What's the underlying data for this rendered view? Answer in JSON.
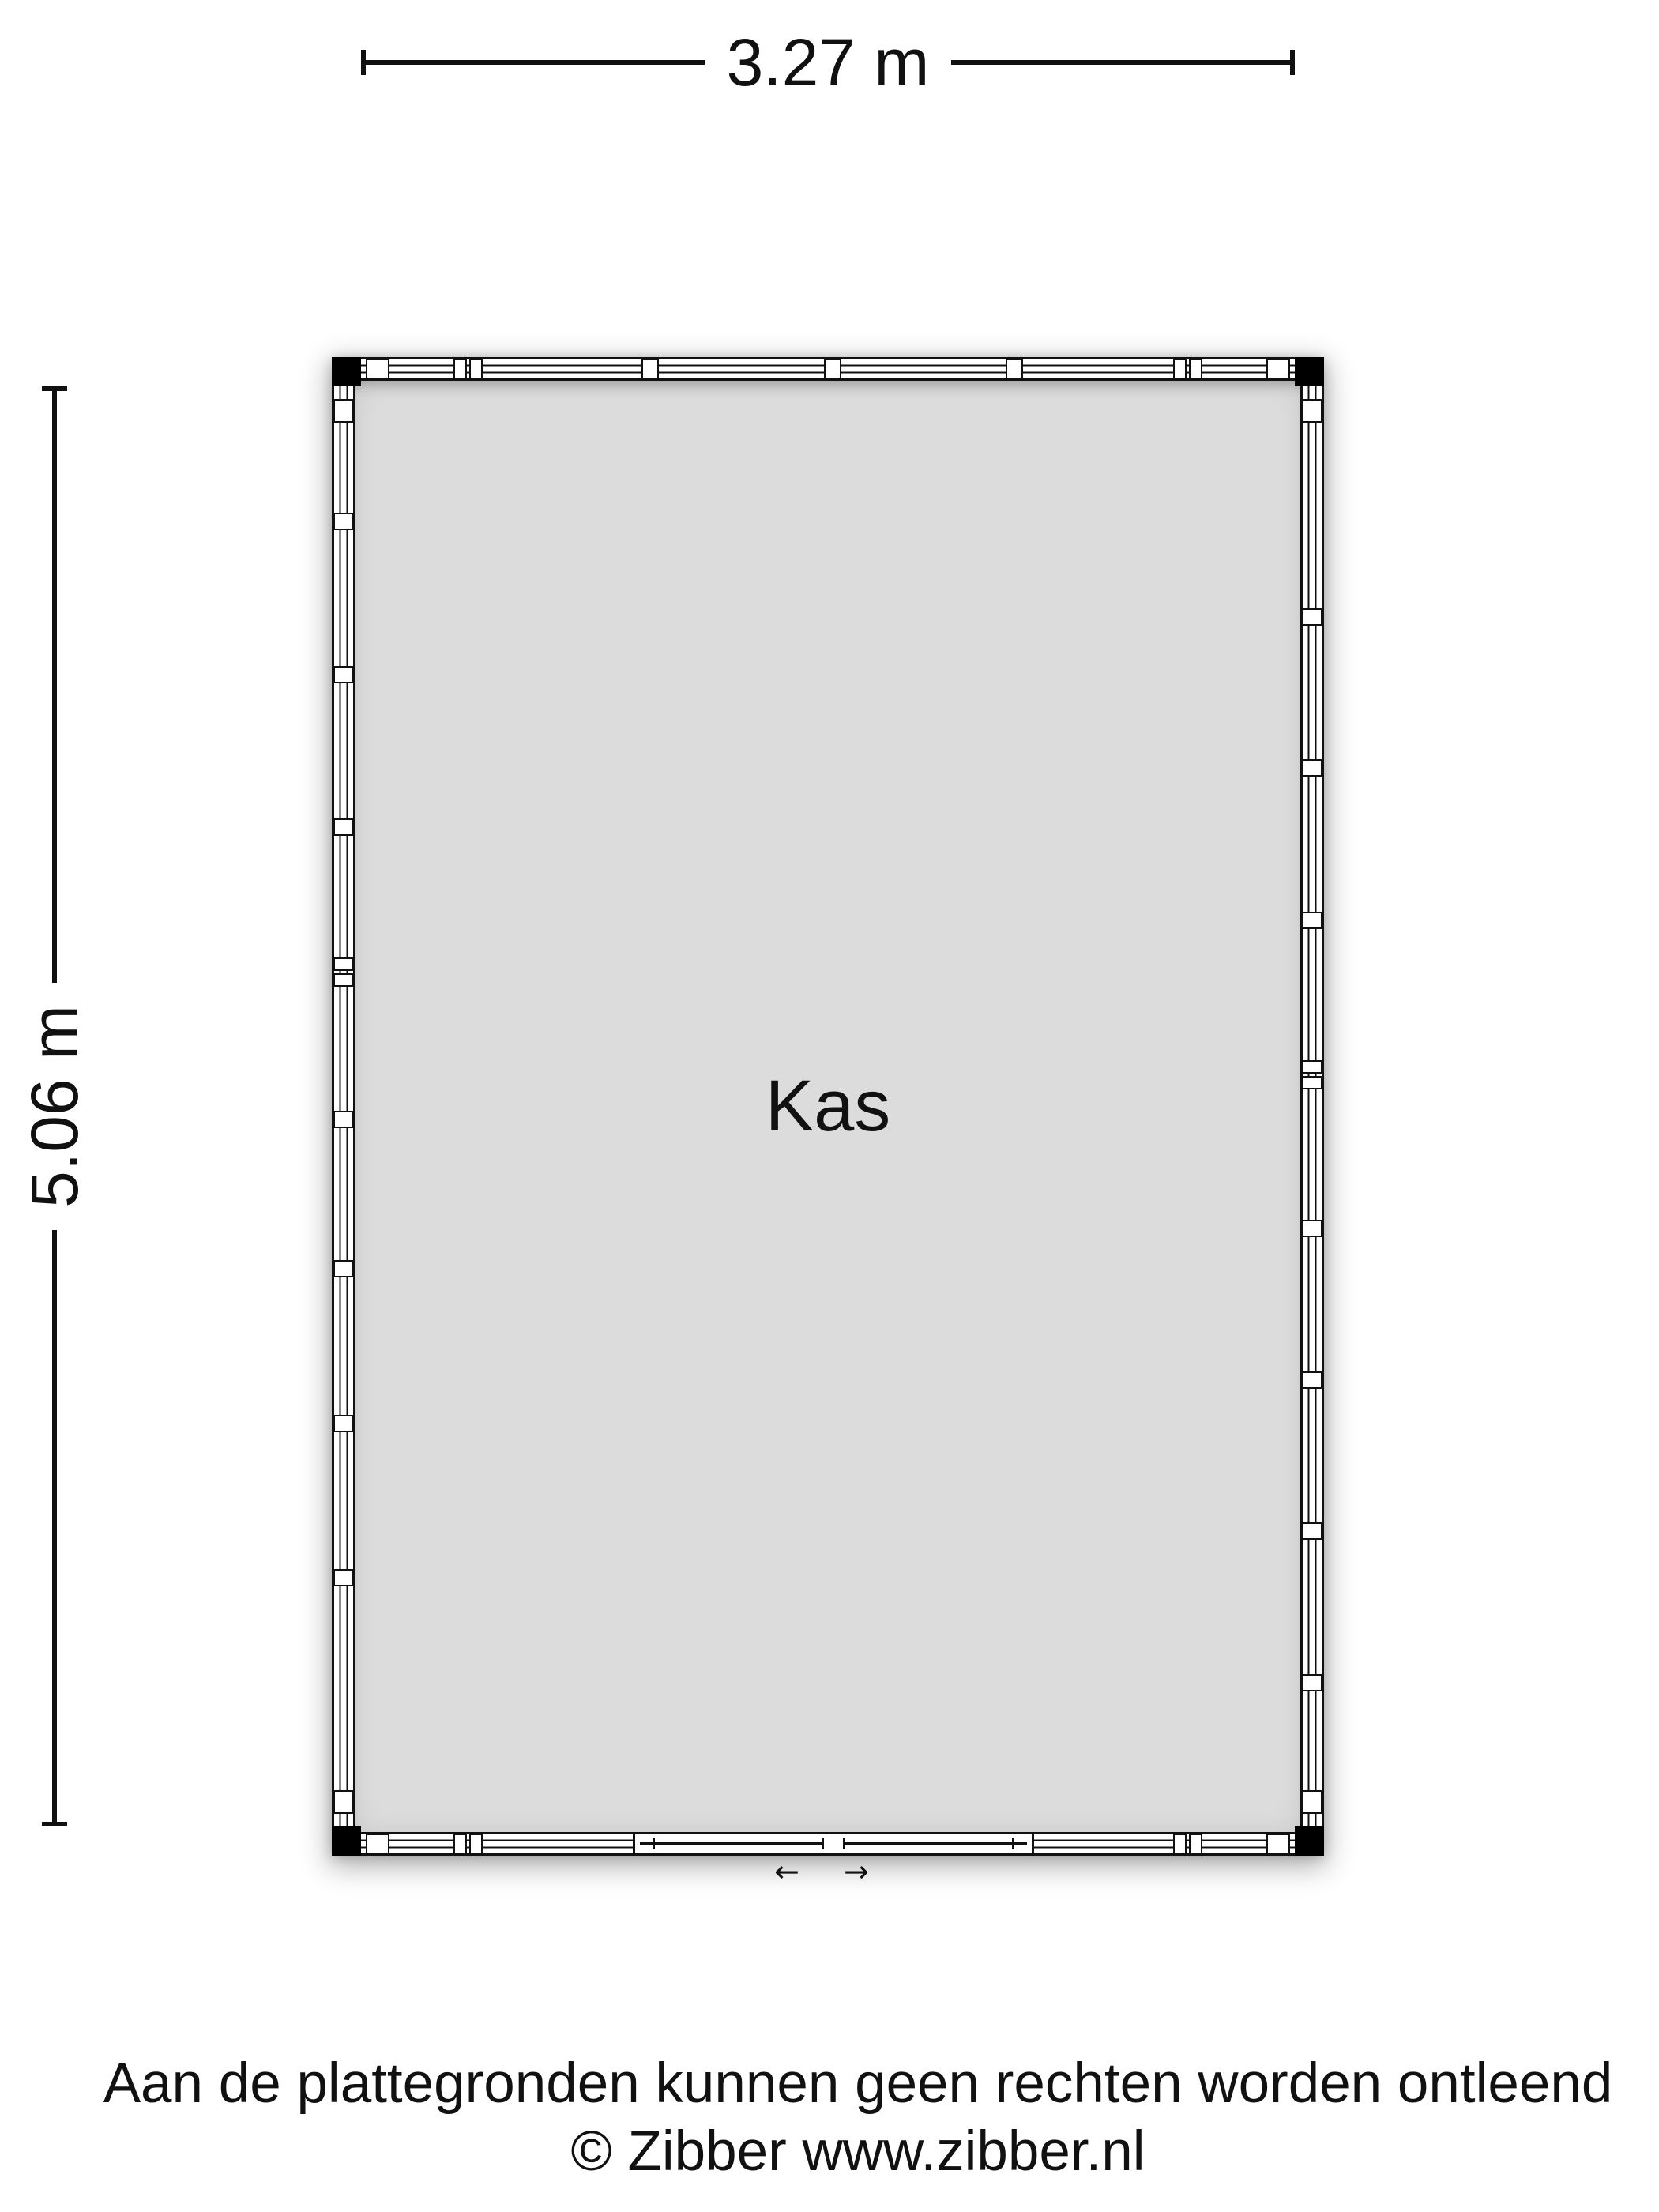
{
  "floor_plan": {
    "room": {
      "label": "Kas"
    },
    "dimensions": {
      "width": "3.27 m",
      "height": "5.06 m"
    },
    "door": {
      "type": "sliding",
      "wall": "bottom"
    }
  },
  "icons": {
    "slide_left": "←",
    "slide_right": "→"
  },
  "footer": {
    "disclaimer": "Aan de plattegronden kunnen geen rechten worden ontleend",
    "copyright": "© Zibber www.zibber.nl"
  },
  "colors": {
    "line": "#111111",
    "room_fill": "#dcdcdc",
    "corner_post": "#000000",
    "background": "#ffffff"
  }
}
